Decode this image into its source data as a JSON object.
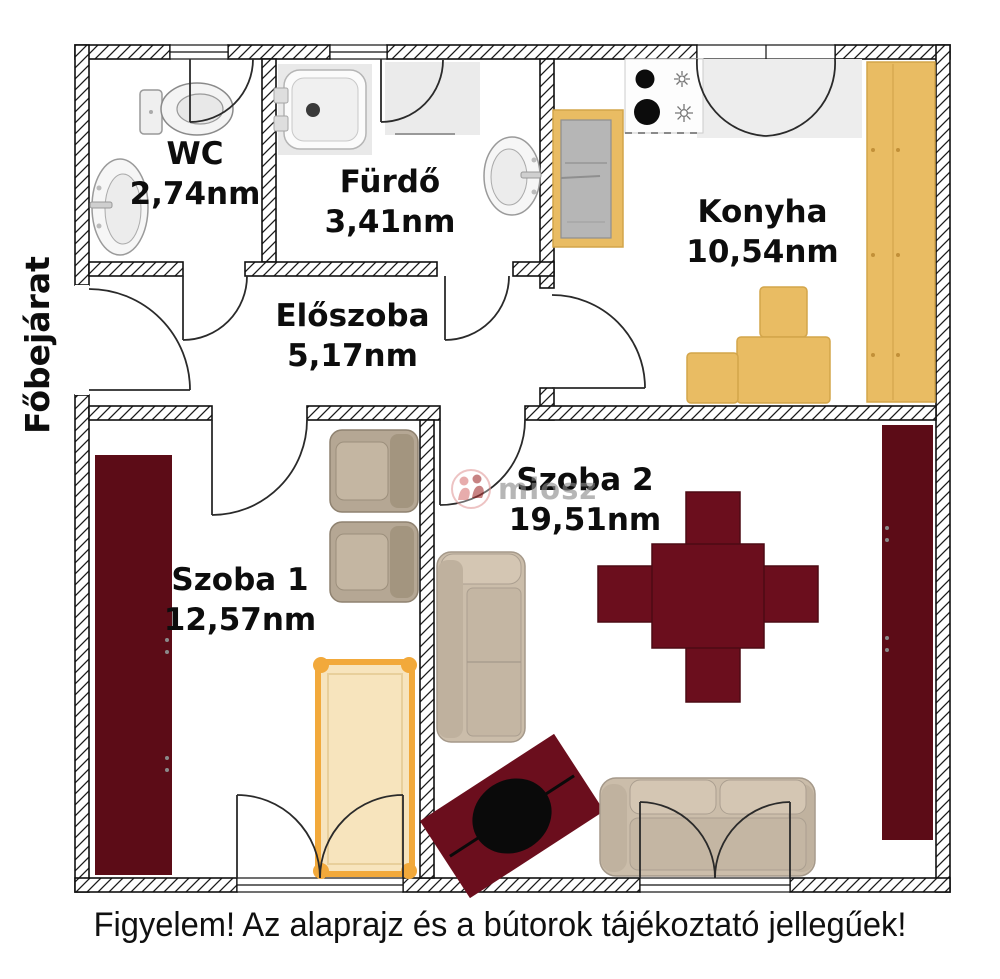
{
  "entrance_label": "Főbejárat",
  "caption": "Figyelem! Az alaprajz és a bútorok tájékoztató jellegűek!",
  "watermark": "miosz",
  "rooms": [
    {
      "name": "WC",
      "area": "2,74nm",
      "furniture": [
        "toilet",
        "sink"
      ]
    },
    {
      "name": "Fürdő",
      "area": "3,41nm",
      "furniture": [
        "shower",
        "washing-machine",
        "sink"
      ]
    },
    {
      "name": "Konyha",
      "area": "10,54nm",
      "furniture": [
        "fridge",
        "stove",
        "tall-cabinet",
        "counter-boxes"
      ]
    },
    {
      "name": "Előszoba",
      "area": "5,17nm",
      "furniture": []
    },
    {
      "name": "Szoba 1",
      "area": "12,57nm",
      "furniture": [
        "wardrobe",
        "armchair",
        "armchair",
        "bed"
      ]
    },
    {
      "name": "Szoba 2",
      "area": "19,51nm",
      "furniture": [
        "sofa",
        "dining-table-with-four-chairs",
        "coffee-table",
        "sofa",
        "wardrobe"
      ]
    }
  ],
  "colors": {
    "wall_line": "#111111",
    "maroon_furniture": "#5c0c17",
    "dining_maroon": "#6b0e1d",
    "wood_yellow": "#e9bc63",
    "bed_frame_orange": "#f2a93b",
    "bed_fill": "#f7e4bd",
    "sofa_beige": "#cbbdaa",
    "glass_gray": "#ededed"
  }
}
